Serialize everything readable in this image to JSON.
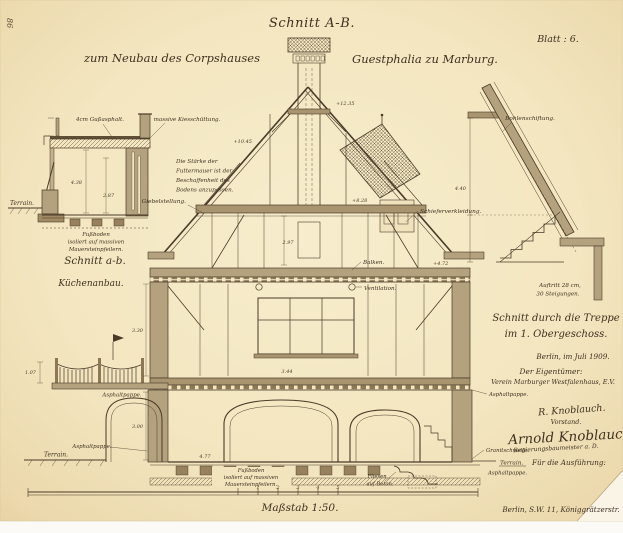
{
  "header": {
    "title": "Schnitt A-B.",
    "sheet": "Blatt : 6.",
    "project_left": "zum Neubau des Corpshauses",
    "project_right": "Guestphalia zu Marburg."
  },
  "stamp": "86",
  "kitchen_detail": {
    "title": "Schnitt a-b.",
    "subtitle": "Küchenanbau.",
    "gussasphalt": "4cm Gußasphalt.",
    "kies": "massive Kiesschüttung.",
    "note": [
      "Die Stärke der",
      "Futtermauer ist der",
      "Beschaffenheit des",
      "Bodens anzupassen."
    ],
    "terrain": "Terrain.",
    "floor_note": [
      "Fußboden",
      "isoliert auf massiven",
      "Mauersteinpfeilern."
    ]
  },
  "main_section": {
    "giebelstellung": "Giebelstellung.",
    "balken": "Balken.",
    "ventilation": "Ventilation.",
    "schiefer": "Schieferverkleidung.",
    "fliesen": [
      "Fliesen",
      "auf Beton."
    ],
    "floor_note": [
      "Fußboden",
      "isoliert auf massiven",
      "Mauersteinpfeilern."
    ],
    "asphalt_fence": "Asphaltpappe.",
    "asphalt_left": "Asphaltpappe.",
    "terrain_left": "Terrain.",
    "asphalt_right": "Asphaltpappe.",
    "granitschwelle": "Granitschwelle.",
    "terrain_right": "Terrain.",
    "asphalt_right2": "Asphaltpappe."
  },
  "stair_detail": {
    "bohlenschiftung": "Bohlenschiftung.",
    "auftritt": [
      "Auftritt 28 cm,",
      "30 Steigungen."
    ],
    "title": [
      "Schnitt durch die Treppe",
      "im 1. Obergeschoss."
    ]
  },
  "title_block": {
    "date": "Berlin, im Juli 1909.",
    "owner_heading": "Der Eigentümer:",
    "owner": "Verein Marburger Westfalenhaus, E.V.",
    "signature1": "R. Knoblauch.",
    "signature1_role": "Vorstand.",
    "signature2": "Arnold Knoblauch",
    "signature2_role": "Regierungsbaumeister a. D.",
    "execution": "Für die Ausführung:",
    "address": "Berlin, S.W. 11, Königgrätzerstr."
  },
  "scale": {
    "label": "Maßstab 1:50.",
    "ticks": [
      "1",
      "2",
      "3",
      "4",
      "5"
    ]
  },
  "dimensions": [
    "+12.35",
    "+10.45",
    "+8.28",
    "+4.72",
    "2.97",
    "3.44",
    "3.30",
    "3.00",
    "4.38",
    "2.87",
    "4.40",
    "4.77",
    "1.07"
  ]
}
